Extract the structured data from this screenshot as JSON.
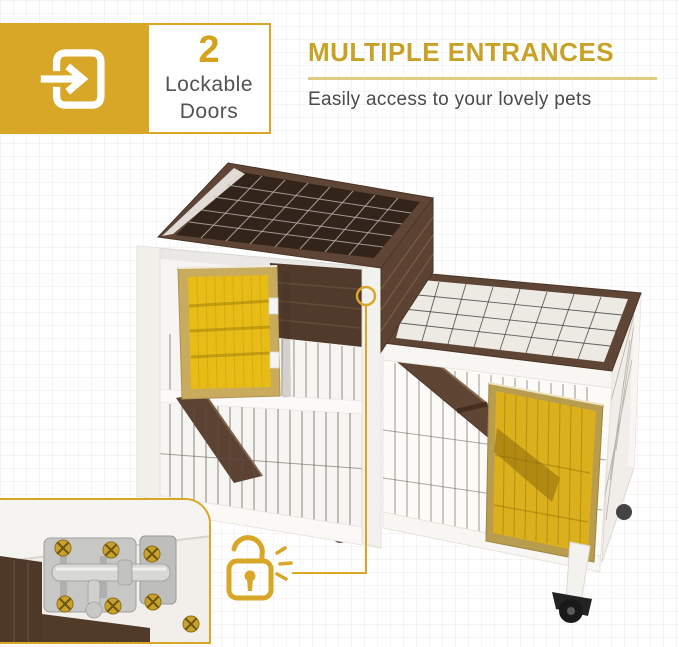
{
  "badge": {
    "number": "2",
    "label_lines": [
      "Lockable",
      "Doors"
    ],
    "icon": "door-enter-icon"
  },
  "headline": {
    "title": "MULTIPLE ENTRANCES",
    "subtitle": "Easily access to your lovely pets"
  },
  "callout": {
    "icon": "open-padlock-icon",
    "points_to": "left-door-latch"
  },
  "photo": {
    "subject": "two-tier wooden rabbit hutch: wire mesh tops, white frame, brown wood panels, two yellow doors, interior ramp, caster wheels"
  },
  "inset": {
    "subject": "close-up of stainless steel slide bolt latch with gold screws"
  },
  "colors": {
    "accent_gold": "#D9A728",
    "headline_gold": "#C8A227",
    "underline_gold": "#DECC85",
    "text_gray": "#4A4A4A",
    "door_yellow": "#E6BB16",
    "wood_brown": "#5E4535",
    "frame_white": "#F7F5F2"
  }
}
